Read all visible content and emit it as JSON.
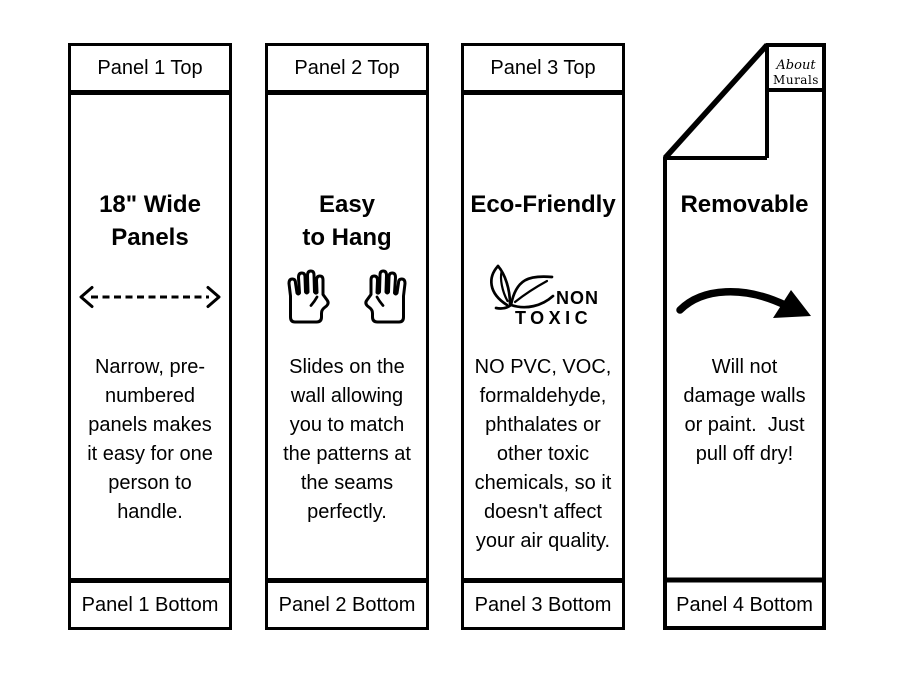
{
  "colors": {
    "ink": "#000000",
    "paper": "#ffffff"
  },
  "panels": [
    {
      "id": "panel-1",
      "top_label": "Panel 1 Top",
      "title": "18\" Wide\nPanels",
      "icon": "dashed-width-arrow",
      "body": "Narrow, pre-\nnumbered\npanels makes\nit easy for one\nperson to\nhandle.",
      "bottom_label": "Panel 1 Bottom"
    },
    {
      "id": "panel-2",
      "top_label": "Panel 2 Top",
      "title": "Easy\nto Hang",
      "icon": "two-raised-hands",
      "body": "Slides on the\nwall allowing\nyou to match\nthe patterns at\nthe seams\nperfectly.",
      "bottom_label": "Panel 2 Bottom"
    },
    {
      "id": "panel-3",
      "top_label": "Panel 3 Top",
      "title": "Eco-Friendly",
      "icon": "non-toxic-leaves",
      "icon_label_top": "NON",
      "icon_label_bottom": "TOXIC",
      "body": "NO PVC, VOC,\nformaldehyde,\nphthalates or\nother toxic\nchemicals, so it\ndoesn't affect\nyour air quality.",
      "bottom_label": "Panel 3 Bottom"
    },
    {
      "id": "panel-4",
      "title": "Removable",
      "icon": "curved-arrow",
      "logo_line1": "About",
      "logo_line2": "Murals",
      "body": "Will not\ndamage walls\nor paint.  Just\npull off dry!",
      "bottom_label": "Panel 4 Bottom"
    }
  ]
}
